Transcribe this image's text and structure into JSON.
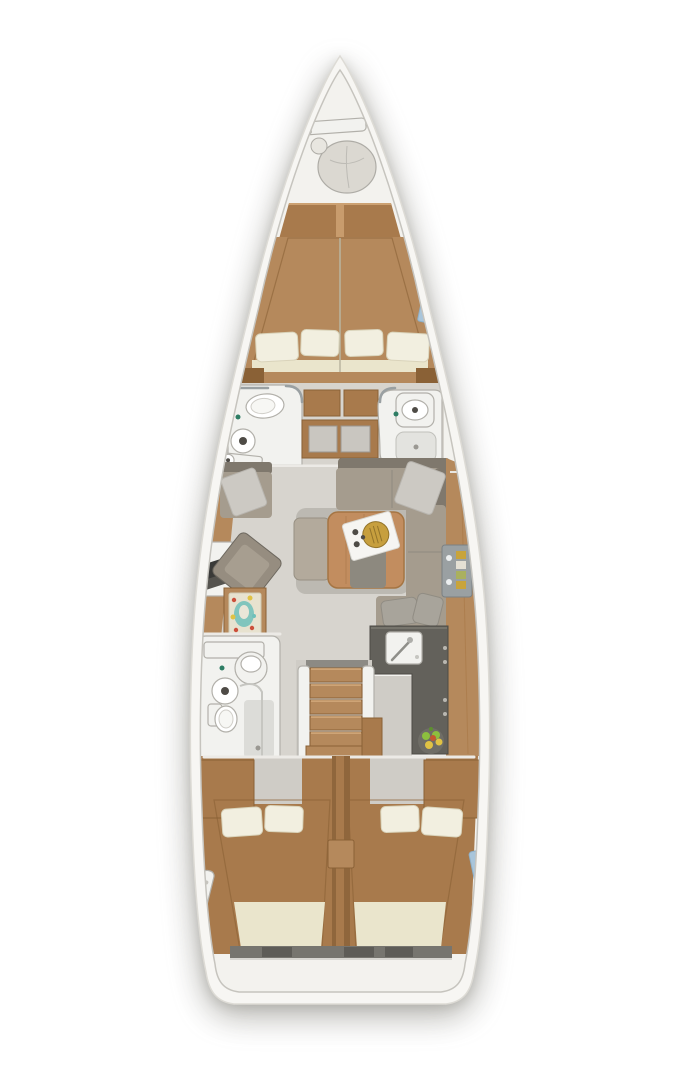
{
  "palette": {
    "bg": "#ffffff",
    "hull": "#f7f6f3",
    "hull_line": "#dddbd5",
    "deck": "#f3f2ee",
    "liner_line": "#c6c4be",
    "floor": "#d7d4ce",
    "floor_dark": "#cfccc6",
    "wood": "#b5895c",
    "wood_light": "#c89c6d",
    "wood_mid": "#a87a4c",
    "wood_dark": "#8a6136",
    "wood_deep": "#8f663c",
    "mattress": "#eae5cc",
    "stripe": "#d6d0b2",
    "pillow": "#f2efe0",
    "pillow_line": "#d9d3ba",
    "sofa": "#a59c8e",
    "sofa_dark": "#7f786d",
    "throw": "#ccc9c3",
    "cushion": "#a8a49b",
    "fixture": "#f2f2ef",
    "fixture_line": "#b2b0aa",
    "porcelain": "#ffffff",
    "steel": "#9aa0a2",
    "galley": "#63615b",
    "galley_line": "#4c4a45",
    "table": "#c28d5f",
    "table_line": "#a57543",
    "pedestal": "#8d897f",
    "tray": "#f6f5f2",
    "gold": "#c79f3e",
    "gold_dark": "#93742a",
    "chart_bg": "#e7e2cf",
    "chart_teal": "#6fc0ba",
    "chart_red": "#cc4f3a",
    "chart_yellow": "#e0c244",
    "fruit_green": "#8cbf3e",
    "fruit_leaf": "#5d8f2f",
    "window": "#a9c5da",
    "faucet_teal": "#2e7d64",
    "dark_dot": "#4e4b46",
    "wall_line": "#eceae6",
    "step_light": "#d7ae7e"
  },
  "diagram": {
    "kind": "yacht-interior-floor-plan",
    "view": "top-down",
    "label": "Sailing yacht interior layout plan, bow at top",
    "areas": [
      {
        "id": "bow-locker",
        "label": "Bow anchor/sail locker"
      },
      {
        "id": "forward-cabin",
        "label": "Forward owner cabin with V-berth"
      },
      {
        "id": "forward-head-port",
        "label": "Forward head (port) with toilet and sink"
      },
      {
        "id": "forward-head-starboard",
        "label": "Forward head (starboard) with sink and shower"
      },
      {
        "id": "salon",
        "label": "Salon with U-sofa, table and stool"
      },
      {
        "id": "nav-station",
        "label": "Navigation station with laptop and chart table"
      },
      {
        "id": "galley",
        "label": "L-shaped galley with sink and fruit bowl"
      },
      {
        "id": "aft-head-port",
        "label": "Aft head (port) with toilet, sink and shower"
      },
      {
        "id": "companionway",
        "label": "Companionway stairs"
      },
      {
        "id": "aft-cabin-port",
        "label": "Aft cabin (port) with double berth"
      },
      {
        "id": "aft-cabin-starboard",
        "label": "Aft cabin (starboard) with double berth"
      },
      {
        "id": "stern",
        "label": "Stern platform"
      }
    ]
  }
}
